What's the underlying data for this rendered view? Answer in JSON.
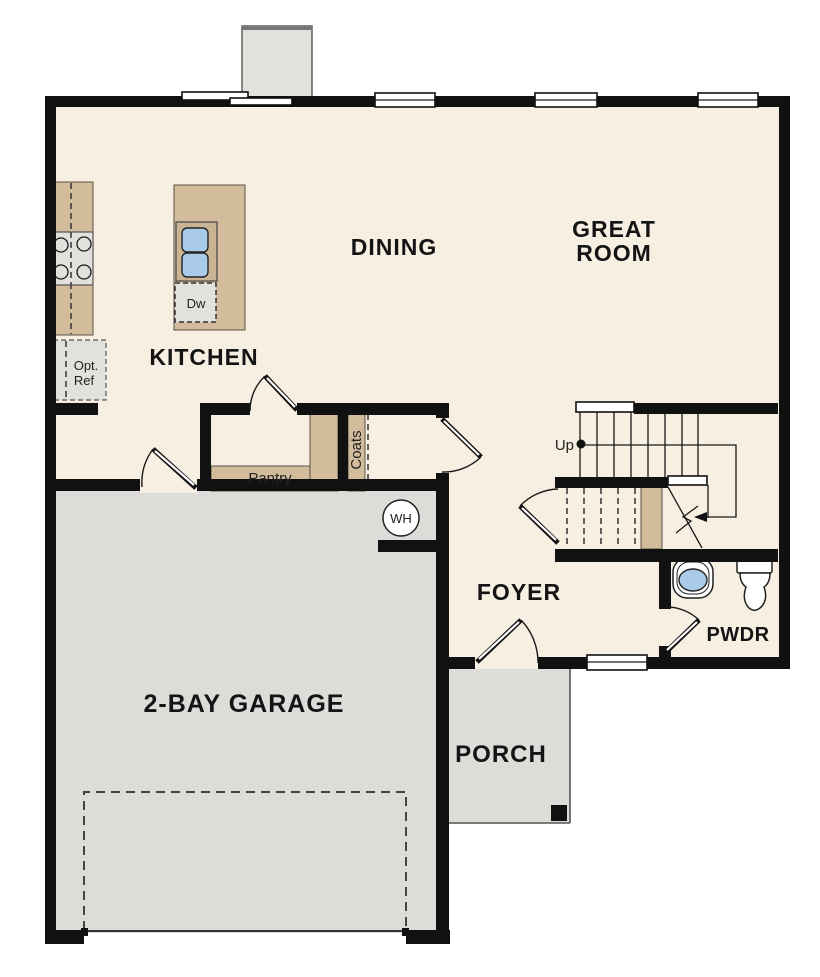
{
  "plan": {
    "rooms": {
      "dining": "DINING",
      "great_room_line1": "GREAT",
      "great_room_line2": "ROOM",
      "kitchen": "KITCHEN",
      "foyer": "FOYER",
      "powder": "PWDR",
      "porch": "PORCH",
      "garage": "2-BAY GARAGE"
    },
    "features": {
      "pantry": "Pantry",
      "coats": "Coats",
      "dishwasher": "Dw",
      "opt_ref_line1": "Opt.",
      "opt_ref_line2": "Ref",
      "water_heater": "WH",
      "stairs_up": "Up"
    },
    "colors": {
      "wall": "#111111",
      "floor": "#f7efe2",
      "garage_floor": "#dedcd9",
      "cabinet_tan": "#d2bc9c",
      "sink_blue": "#a9cbe9",
      "appliance_gray": "#e3e1de"
    }
  }
}
